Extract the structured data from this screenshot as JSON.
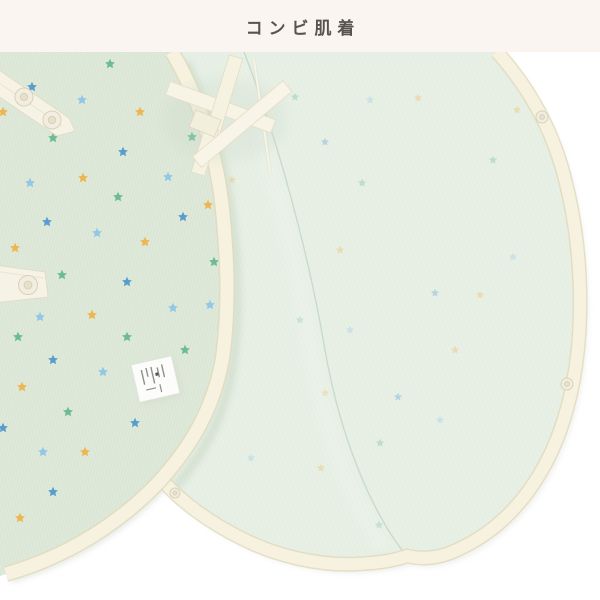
{
  "header": {
    "title": "コンビ肌着"
  },
  "photo": {
    "palette": {
      "band_bg": "#faf5f0",
      "background": "#ffffff",
      "front_panel": "#dfe9da",
      "back_panel": "#e8f0e6",
      "binding": "#f6f2df",
      "binding_edge": "#e0dabe",
      "seam": "#b7cfbf",
      "label_white": "#fcfcfa",
      "star_blue": "#4a95cc",
      "star_lightblue": "#8ac4e8",
      "star_green": "#5eb68f",
      "star_yellow": "#f0b040"
    },
    "front_stars": [
      [
        110,
        64,
        "G"
      ],
      [
        182,
        63,
        "B"
      ],
      [
        32,
        87,
        "B"
      ],
      [
        82,
        100,
        "LB"
      ],
      [
        3,
        112,
        "Y"
      ],
      [
        140,
        112,
        "Y"
      ],
      [
        53,
        138,
        "G"
      ],
      [
        192,
        137,
        "G"
      ],
      [
        123,
        152,
        "B"
      ],
      [
        30,
        183,
        "LB"
      ],
      [
        83,
        178,
        "Y"
      ],
      [
        168,
        177,
        "LB"
      ],
      [
        118,
        197,
        "G"
      ],
      [
        183,
        217,
        "B"
      ],
      [
        47,
        222,
        "B"
      ],
      [
        97,
        233,
        "LB"
      ],
      [
        15,
        248,
        "Y"
      ],
      [
        145,
        242,
        "Y"
      ],
      [
        62,
        275,
        "G"
      ],
      [
        127,
        282,
        "B"
      ],
      [
        173,
        308,
        "LB"
      ],
      [
        40,
        317,
        "LB"
      ],
      [
        92,
        315,
        "Y"
      ],
      [
        18,
        337,
        "G"
      ],
      [
        127,
        337,
        "G"
      ],
      [
        53,
        360,
        "B"
      ],
      [
        103,
        372,
        "LB"
      ],
      [
        185,
        350,
        "G"
      ],
      [
        22,
        387,
        "Y"
      ],
      [
        68,
        412,
        "G"
      ],
      [
        135,
        423,
        "B"
      ],
      [
        3,
        428,
        "B"
      ],
      [
        43,
        452,
        "LB"
      ],
      [
        85,
        452,
        "Y"
      ],
      [
        53,
        492,
        "B"
      ],
      [
        20,
        518,
        "Y"
      ],
      [
        208,
        205,
        "Y"
      ],
      [
        214,
        262,
        "G"
      ],
      [
        210,
        305,
        "LB"
      ]
    ],
    "back_stars": [
      [
        295,
        97,
        "G"
      ],
      [
        370,
        100,
        "LB"
      ],
      [
        418,
        98,
        "Y"
      ],
      [
        517,
        110,
        "Y"
      ],
      [
        362,
        183,
        "G"
      ],
      [
        325,
        142,
        "B"
      ],
      [
        493,
        160,
        "G"
      ],
      [
        513,
        257,
        "LB"
      ],
      [
        435,
        293,
        "B"
      ],
      [
        480,
        295,
        "Y"
      ],
      [
        340,
        250,
        "Y"
      ],
      [
        350,
        330,
        "LB"
      ],
      [
        300,
        320,
        "G"
      ],
      [
        398,
        397,
        "B"
      ],
      [
        325,
        393,
        "Y"
      ],
      [
        380,
        443,
        "G"
      ],
      [
        440,
        420,
        "LB"
      ],
      [
        251,
        458,
        "LB"
      ],
      [
        321,
        468,
        "Y"
      ],
      [
        379,
        525,
        "G"
      ],
      [
        232,
        180,
        "Y"
      ],
      [
        455,
        350,
        "Y"
      ]
    ],
    "tape_snaps": [
      [
        24,
        97,
        9
      ],
      [
        52,
        120,
        9
      ],
      [
        28,
        285,
        9.5
      ]
    ],
    "edge_snaps": [
      [
        542,
        117,
        6
      ],
      [
        567,
        384,
        6
      ],
      [
        175,
        493,
        5
      ]
    ]
  }
}
